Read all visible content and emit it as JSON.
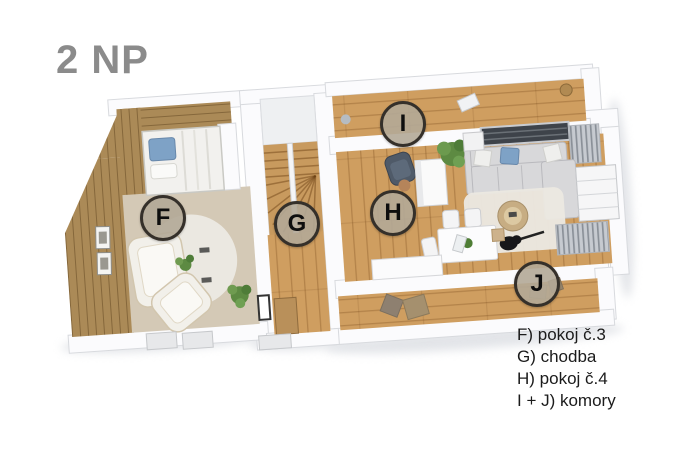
{
  "title": "2 NP",
  "legend": {
    "items": [
      {
        "label": "F) pokoj č.3"
      },
      {
        "label": "G) chodba"
      },
      {
        "label": "H) pokoj č.4"
      },
      {
        "label": "I + J) komory"
      }
    ]
  },
  "room_labels": [
    {
      "letter": "F",
      "room": "pokoj č.3",
      "x": 163,
      "y": 218
    },
    {
      "letter": "G",
      "room": "chodba",
      "x": 297,
      "y": 224
    },
    {
      "letter": "H",
      "room": "pokoj č.4",
      "x": 393,
      "y": 213
    },
    {
      "letter": "I",
      "room": "komora",
      "x": 403,
      "y": 124
    },
    {
      "letter": "J",
      "room": "komora",
      "x": 537,
      "y": 284
    }
  ],
  "colors": {
    "wood_floor": "#cf9e60",
    "wood_wall": "#ab8a57",
    "carpet": "#d4c9b6",
    "wall_fill": "#fbfbfd",
    "title_color": "#8b8b8b",
    "legend_color": "#1b1b1b",
    "label_ring": "#35302a",
    "label_fill": "rgba(178,169,151,0.9)",
    "sofa_gray": "#d8d8da",
    "rug_white": "#ebe8e1",
    "plant_green": "#5d8a42",
    "pillow_blue": "#7ea2c6",
    "skylight_dark": "#3e434a"
  }
}
